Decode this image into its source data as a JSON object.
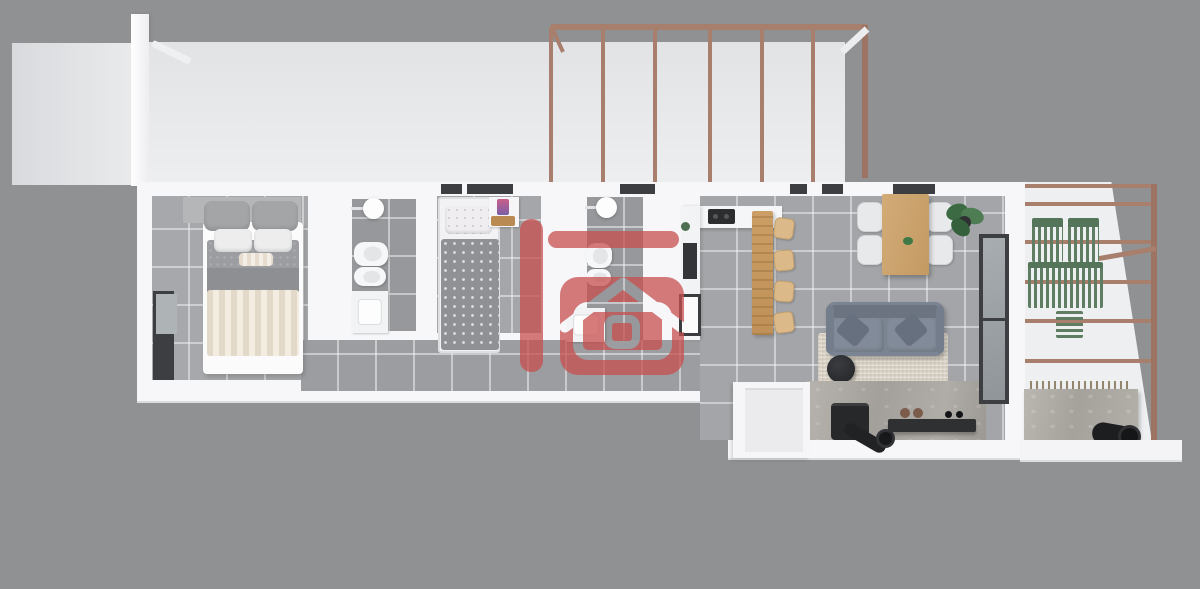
{
  "scene": {
    "type": "3d-floor-plan-render",
    "description_visible_text": "",
    "watermark": {
      "icon": "house-logo-icon",
      "opacity": 0.75
    }
  },
  "colors": {
    "bg": "#909192",
    "wall": "#f7f7f9",
    "room_floor": "#a6a8ab",
    "bath_floor": "#96989b",
    "living_floor": "#a3a5a8",
    "grout": "rgba(236,238,240,.55)",
    "copper": "#a87f6d",
    "wood": "#c89b62",
    "wood_light": "#dcb988",
    "sofa": "#7b8492",
    "sofa_dark": "#67707e",
    "rug": "#d7d0c3",
    "green": "#5e7d62",
    "concrete": "#b0aca6",
    "dark": "#2b2d2f",
    "frame_dark": "#3c3e41",
    "glass": "#9aa0a4",
    "red": "#c94f4f"
  },
  "inventory": {
    "upper_terrace": [
      "terrace-floor",
      "pergola-frame"
    ],
    "bedroom_1": [
      "double-bed",
      "headboard-shelf",
      "pillows",
      "striped-blanket",
      "window"
    ],
    "bathroom_1": [
      "shower-head",
      "toilet",
      "bidet",
      "vanity-sink"
    ],
    "bedroom_2": [
      "single-bed",
      "patterned-duvet",
      "nightstand",
      "toy"
    ],
    "bathroom_2": [
      "shower-head",
      "toilet",
      "bidet",
      "vanity-sink"
    ],
    "kitchen": [
      "counter",
      "cooktop",
      "oven",
      "fridge",
      "breakfast-bar",
      "stools"
    ],
    "dining": [
      "wood-table",
      "chairs",
      "potted-plant"
    ],
    "living": [
      "sofa",
      "throw-pillows",
      "rug",
      "round-coffee-table",
      "wood-stove",
      "stove-pipe",
      "wall-shelf",
      "glass-door"
    ],
    "right_terrace": [
      "pergola-bars",
      "green-slatted-chairs",
      "green-slatted-sofa",
      "green-side-table",
      "concrete-counter",
      "black-pipe"
    ]
  }
}
